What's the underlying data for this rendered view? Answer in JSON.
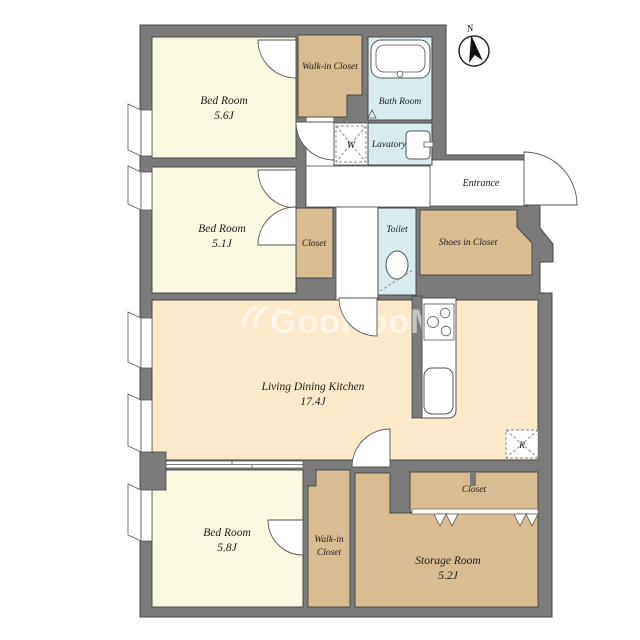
{
  "title": "Apartment floor plan",
  "palette": {
    "wall": "#7b7b7b",
    "bedroom": "#faf8e1",
    "closet": "#d8bd92",
    "wet": "#d9edf1",
    "ldk": "#fbe9cc",
    "corridor": "#ffffff",
    "outline": "#4a4a4a",
    "label": "#1c1c1c"
  },
  "compass": {
    "label": "N"
  },
  "watermark": {
    "text": "GooRooM"
  },
  "rooms": {
    "bed56": {
      "name": "Bed Room",
      "area": "5.6J"
    },
    "wic_top": {
      "name": "Walk-in Closet"
    },
    "bath": {
      "name": "Bath Room"
    },
    "washer": {
      "label": "W"
    },
    "lavatory": {
      "name": "Lavatory"
    },
    "entrance": {
      "name": "Entrance"
    },
    "bed51": {
      "name": "Bed Room",
      "area": "5.1J"
    },
    "closet51": {
      "name": "Closet"
    },
    "toilet": {
      "name": "Toilet"
    },
    "shoes": {
      "name": "Shoes in Closet"
    },
    "ldk": {
      "name": "Living Dining Kitchen",
      "area": "17.4J"
    },
    "fridge": {
      "label": "R"
    },
    "bed58": {
      "name": "Bed Room",
      "area": "5.8J"
    },
    "wic_bottom": {
      "line1": "Walk-in",
      "line2": "Closet"
    },
    "closet_storage": {
      "name": "Closet"
    },
    "storage": {
      "name": "Storage Room",
      "area": "5.2J"
    }
  }
}
